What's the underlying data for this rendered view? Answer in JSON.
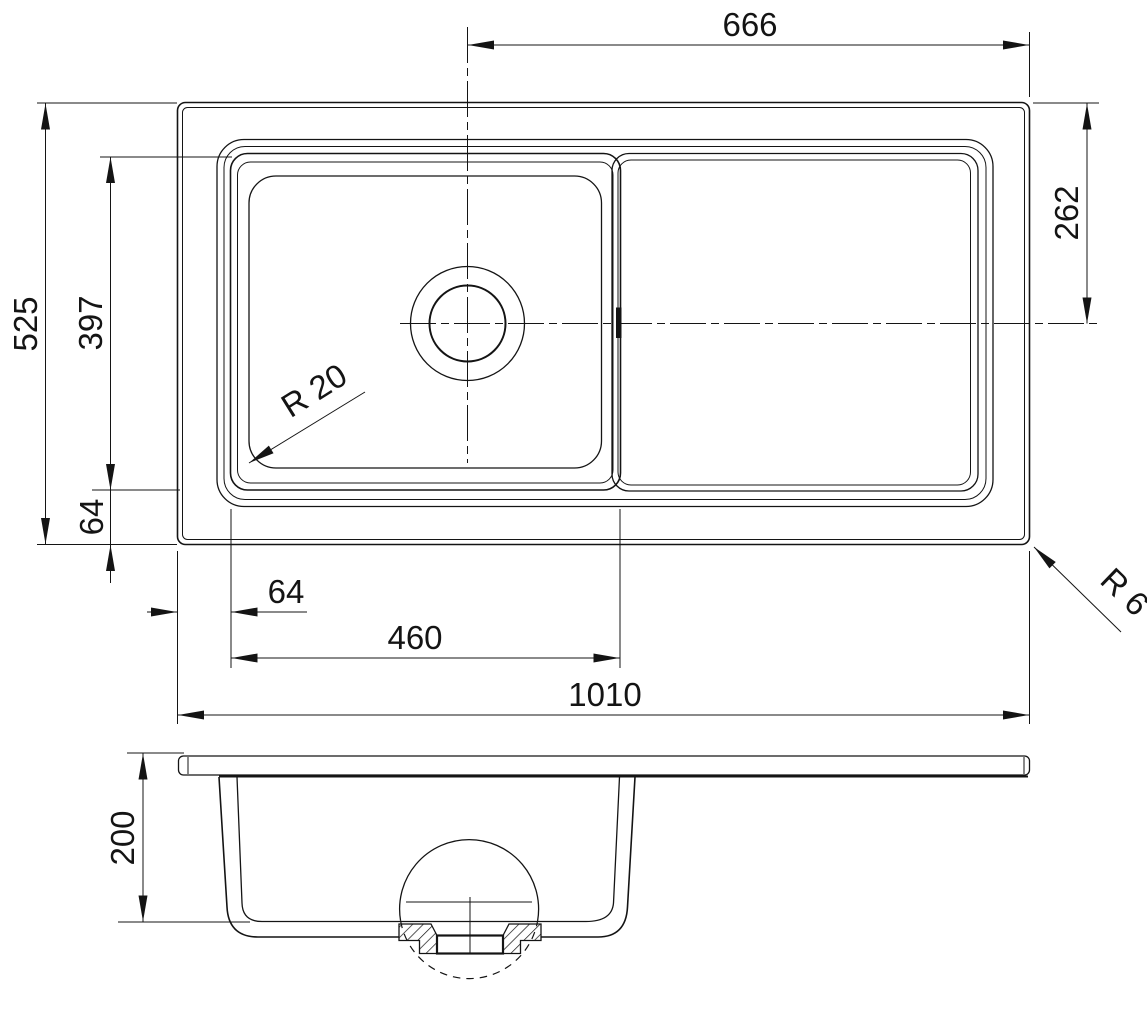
{
  "colors": {
    "line": "#141414",
    "background": "#ffffff"
  },
  "top_view": {
    "dim_drain_to_right_edge": "666",
    "dim_overall_depth": "525",
    "dim_bowl_length_vertical": "397",
    "dim_bowl_to_bottom_edge": "64",
    "dim_drain_center_from_top_edge": "262",
    "label_bowl_corner_radius": "R 20",
    "label_outer_corner_radius": "R 6",
    "dim_left_edge_to_bowl": "64",
    "dim_bowl_width": "460",
    "dim_overall_length": "1010"
  },
  "side_view": {
    "dim_bowl_depth": "200"
  }
}
